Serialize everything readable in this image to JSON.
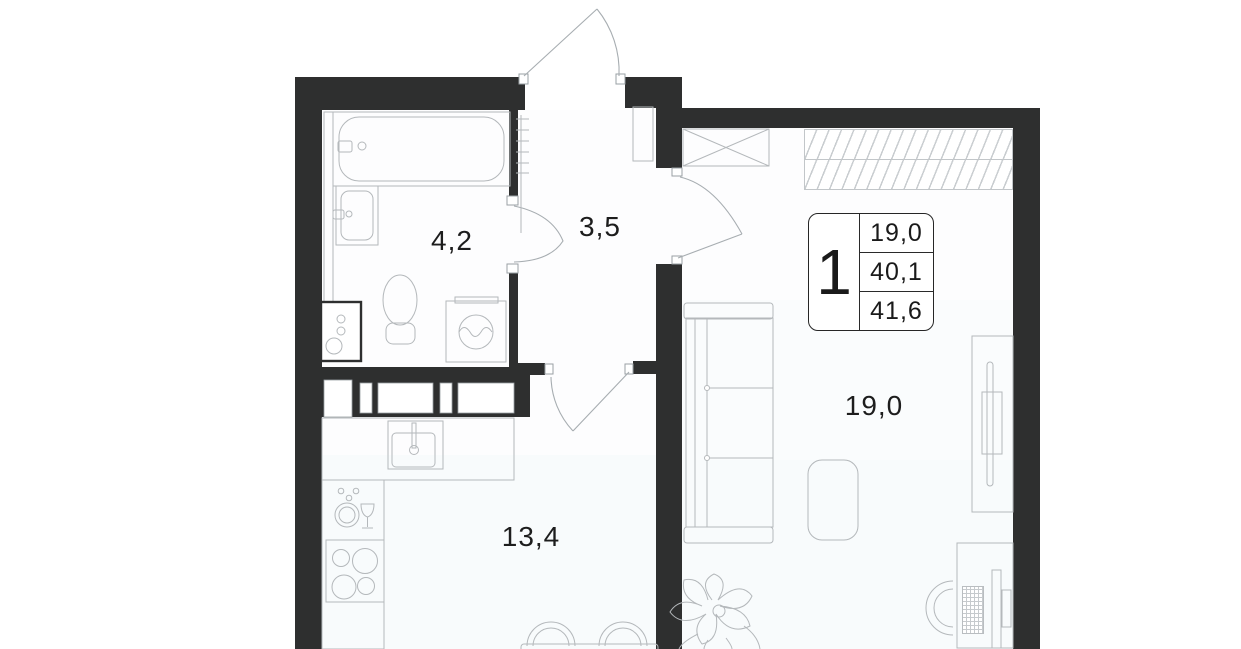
{
  "badge": {
    "rooms": "1",
    "living_area": "19,0",
    "area_no_balcony": "40,1",
    "total_area": "41,6"
  },
  "rooms": {
    "bathroom": {
      "label": "4,2"
    },
    "hallway": {
      "label": "3,5"
    },
    "kitchen": {
      "label": "13,4"
    },
    "living": {
      "label": "19,0"
    }
  },
  "icons": [
    "bathtub-icon",
    "sink-icon",
    "toilet-icon",
    "washing-machine-icon",
    "boiler-icon",
    "radiator-icon",
    "entrance-door-icon",
    "bathroom-door-icon",
    "kitchen-door-icon",
    "living-room-door-icon",
    "closet-icon",
    "wardrobe-icon",
    "sofa-icon",
    "ottoman-icon",
    "tv-console-icon",
    "desk-icon",
    "desk-chair-icon",
    "kitchen-counter-icon",
    "kitchen-sink-icon",
    "stove-icon",
    "dishes-icon",
    "dining-chair-icon",
    "dining-table-icon",
    "plant-icon"
  ],
  "colors": {
    "wall": "#2e2f2f",
    "furniture_line": "#b4b8bb",
    "door_line": "#a7adb1",
    "floor_tint": "#f8fbfc",
    "text": "#1d1d1d"
  }
}
